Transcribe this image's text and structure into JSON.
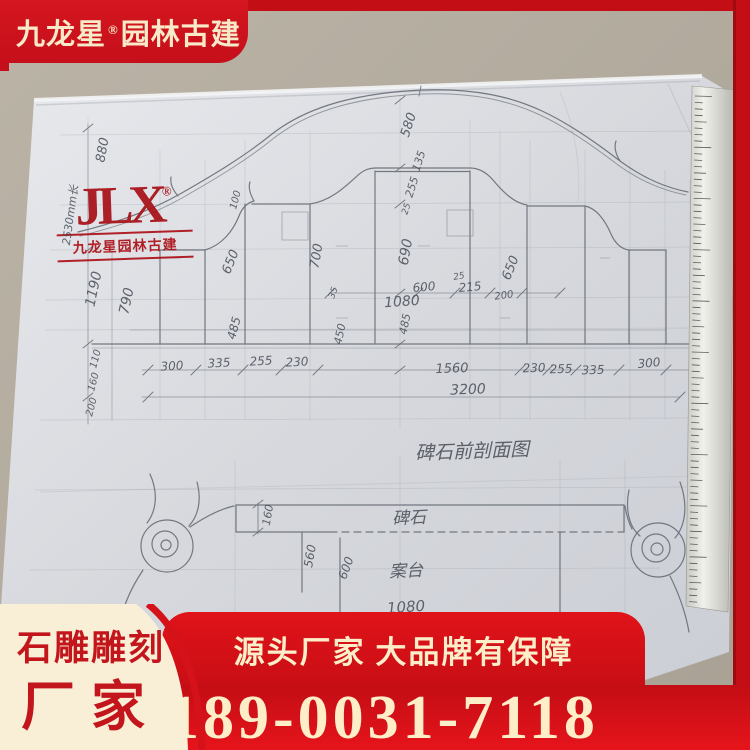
{
  "brand_banner": {
    "name": "九龙星",
    "reg": "®",
    "suffix": "园林古建"
  },
  "stamp": {
    "monogram": "JLX",
    "reg": "®",
    "caption": "九龙星园林古建"
  },
  "footer": {
    "card_line1": "石雕雕刻",
    "card_line2": "厂家",
    "slogan": "源头厂家 大品牌有保障",
    "phone": "189-0031-7118"
  },
  "colors": {
    "banner_red": "#c50f1a",
    "deep_red": "#9e0b11",
    "cream_text": "#f8e9c8",
    "card_cream": "#f9efd7",
    "card_text_red": "#c3161c",
    "pencil": "#686d76",
    "paper": "#d6d8dd",
    "floor": "#b2ab9e"
  },
  "sketch": {
    "title": "碑石前剖面图",
    "labels": [
      {
        "t": "880",
        "x": 103,
        "y": 150,
        "r": -80,
        "s": 13
      },
      {
        "t": "2530mm长",
        "x": 70,
        "y": 215,
        "r": -82,
        "s": 11
      },
      {
        "t": "1190",
        "x": 94,
        "y": 289,
        "r": -78,
        "s": 14
      },
      {
        "t": "790",
        "x": 127,
        "y": 301,
        "r": -78,
        "s": 14
      },
      {
        "t": "110",
        "x": 96,
        "y": 359,
        "r": -75,
        "s": 10
      },
      {
        "t": "160",
        "x": 94,
        "y": 382,
        "r": -75,
        "s": 10
      },
      {
        "t": "200",
        "x": 92,
        "y": 407,
        "r": -75,
        "s": 10
      },
      {
        "t": "100",
        "x": 236,
        "y": 200,
        "r": -75,
        "s": 10
      },
      {
        "t": "650",
        "x": 231,
        "y": 262,
        "r": -68,
        "s": 13
      },
      {
        "t": "485",
        "x": 234,
        "y": 328,
        "r": -75,
        "s": 12
      },
      {
        "t": "700",
        "x": 317,
        "y": 256,
        "r": -80,
        "s": 13
      },
      {
        "t": "35",
        "x": 334,
        "y": 293,
        "r": -70,
        "s": 9
      },
      {
        "t": "450",
        "x": 340,
        "y": 334,
        "r": -78,
        "s": 11
      },
      {
        "t": "580",
        "x": 409,
        "y": 125,
        "r": -72,
        "s": 13
      },
      {
        "t": "135",
        "x": 419,
        "y": 161,
        "r": -72,
        "s": 11
      },
      {
        "t": "255",
        "x": 412,
        "y": 187,
        "r": -72,
        "s": 11
      },
      {
        "t": "25",
        "x": 407,
        "y": 209,
        "r": -72,
        "s": 9
      },
      {
        "t": "690",
        "x": 406,
        "y": 252,
        "r": -80,
        "s": 14
      },
      {
        "t": "600",
        "x": 424,
        "y": 287,
        "r": -5,
        "s": 12
      },
      {
        "t": "25",
        "x": 459,
        "y": 277,
        "r": -10,
        "s": 9
      },
      {
        "t": "215",
        "x": 470,
        "y": 287,
        "r": -5,
        "s": 12
      },
      {
        "t": "200",
        "x": 504,
        "y": 296,
        "r": -8,
        "s": 10
      },
      {
        "t": "650",
        "x": 511,
        "y": 268,
        "r": -68,
        "s": 13
      },
      {
        "t": "1080",
        "x": 402,
        "y": 302,
        "r": -4,
        "s": 14
      },
      {
        "t": "485",
        "x": 405,
        "y": 324,
        "r": -78,
        "s": 11
      },
      {
        "t": "300",
        "x": 172,
        "y": 366,
        "r": -3,
        "s": 12
      },
      {
        "t": "335",
        "x": 219,
        "y": 363,
        "r": -3,
        "s": 12
      },
      {
        "t": "255",
        "x": 261,
        "y": 361,
        "r": -3,
        "s": 12
      },
      {
        "t": "230",
        "x": 297,
        "y": 362,
        "r": -3,
        "s": 12
      },
      {
        "t": "1560",
        "x": 452,
        "y": 369,
        "r": -2,
        "s": 13
      },
      {
        "t": "230",
        "x": 534,
        "y": 368,
        "r": -2,
        "s": 12
      },
      {
        "t": "255",
        "x": 561,
        "y": 369,
        "r": -2,
        "s": 12
      },
      {
        "t": "335",
        "x": 593,
        "y": 370,
        "r": -2,
        "s": 12
      },
      {
        "t": "300",
        "x": 649,
        "y": 363,
        "r": -5,
        "s": 12
      },
      {
        "t": "3200",
        "x": 468,
        "y": 390,
        "r": -2,
        "s": 14
      },
      {
        "t": "碑石前剖面图",
        "x": 472,
        "y": 450,
        "r": -2,
        "s": 19
      },
      {
        "t": "160",
        "x": 268,
        "y": 515,
        "r": -80,
        "s": 11
      },
      {
        "t": "碑石",
        "x": 409,
        "y": 516,
        "r": -3,
        "s": 17
      },
      {
        "t": "560",
        "x": 310,
        "y": 556,
        "r": -80,
        "s": 12
      },
      {
        "t": "600",
        "x": 346,
        "y": 568,
        "r": -70,
        "s": 12
      },
      {
        "t": "案台",
        "x": 406,
        "y": 569,
        "r": -3,
        "s": 17
      },
      {
        "t": "1080",
        "x": 406,
        "y": 607,
        "r": -4,
        "s": 15
      }
    ]
  }
}
